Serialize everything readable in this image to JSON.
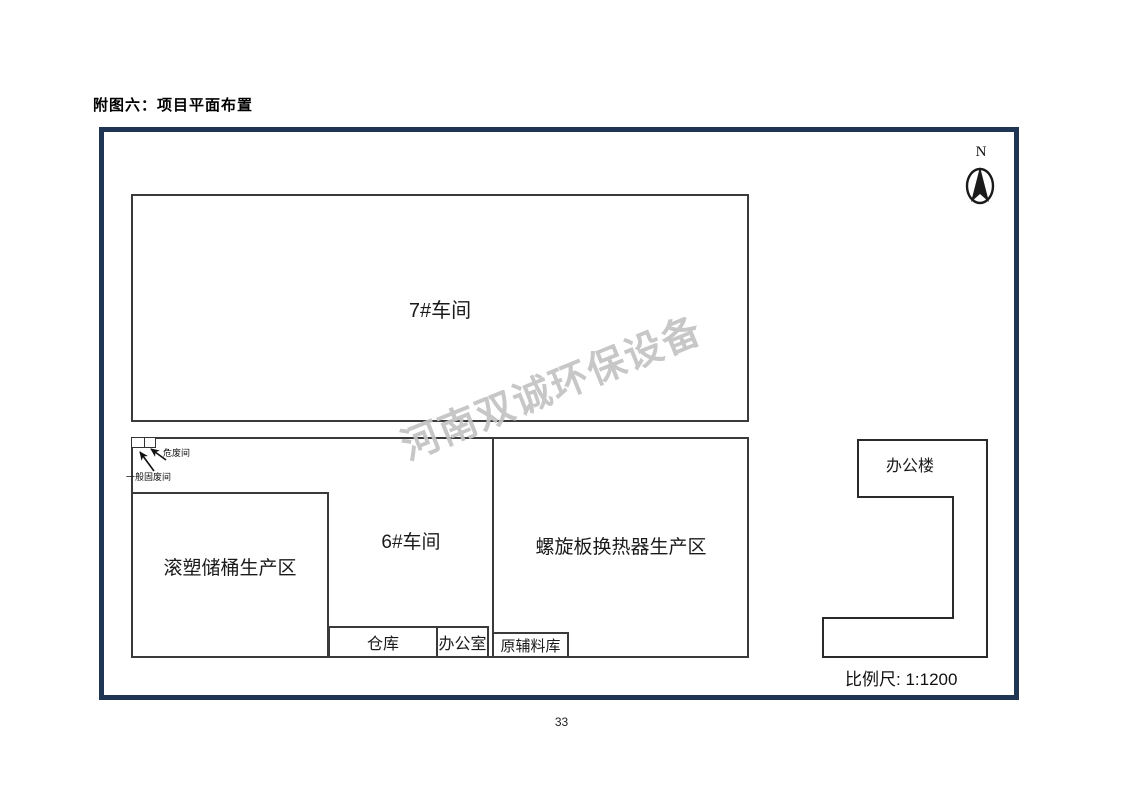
{
  "page": {
    "title": "附图六：项目平面布置",
    "page_number": "33"
  },
  "diagram": {
    "watermark": "河南双诚环保设备",
    "north_label": "N",
    "scale_label": "比例尺: 1:1200",
    "colors": {
      "frame_border": "#1e3553",
      "line": "#3a3a3a",
      "watermark": "#c3c3c3"
    },
    "buildings": {
      "workshop7": "7#车间",
      "workshop6": "6#车间",
      "rotomolding_area": "滚塑储桶生产区",
      "spiral_area": "螺旋板换热器生产区",
      "warehouse": "仓库",
      "office_room": "办公室",
      "raw_material_store": "原辅料库",
      "office_building": "办公楼",
      "hazardous_waste_room": "危废间",
      "general_solid_waste_room": "一般固废间"
    }
  }
}
